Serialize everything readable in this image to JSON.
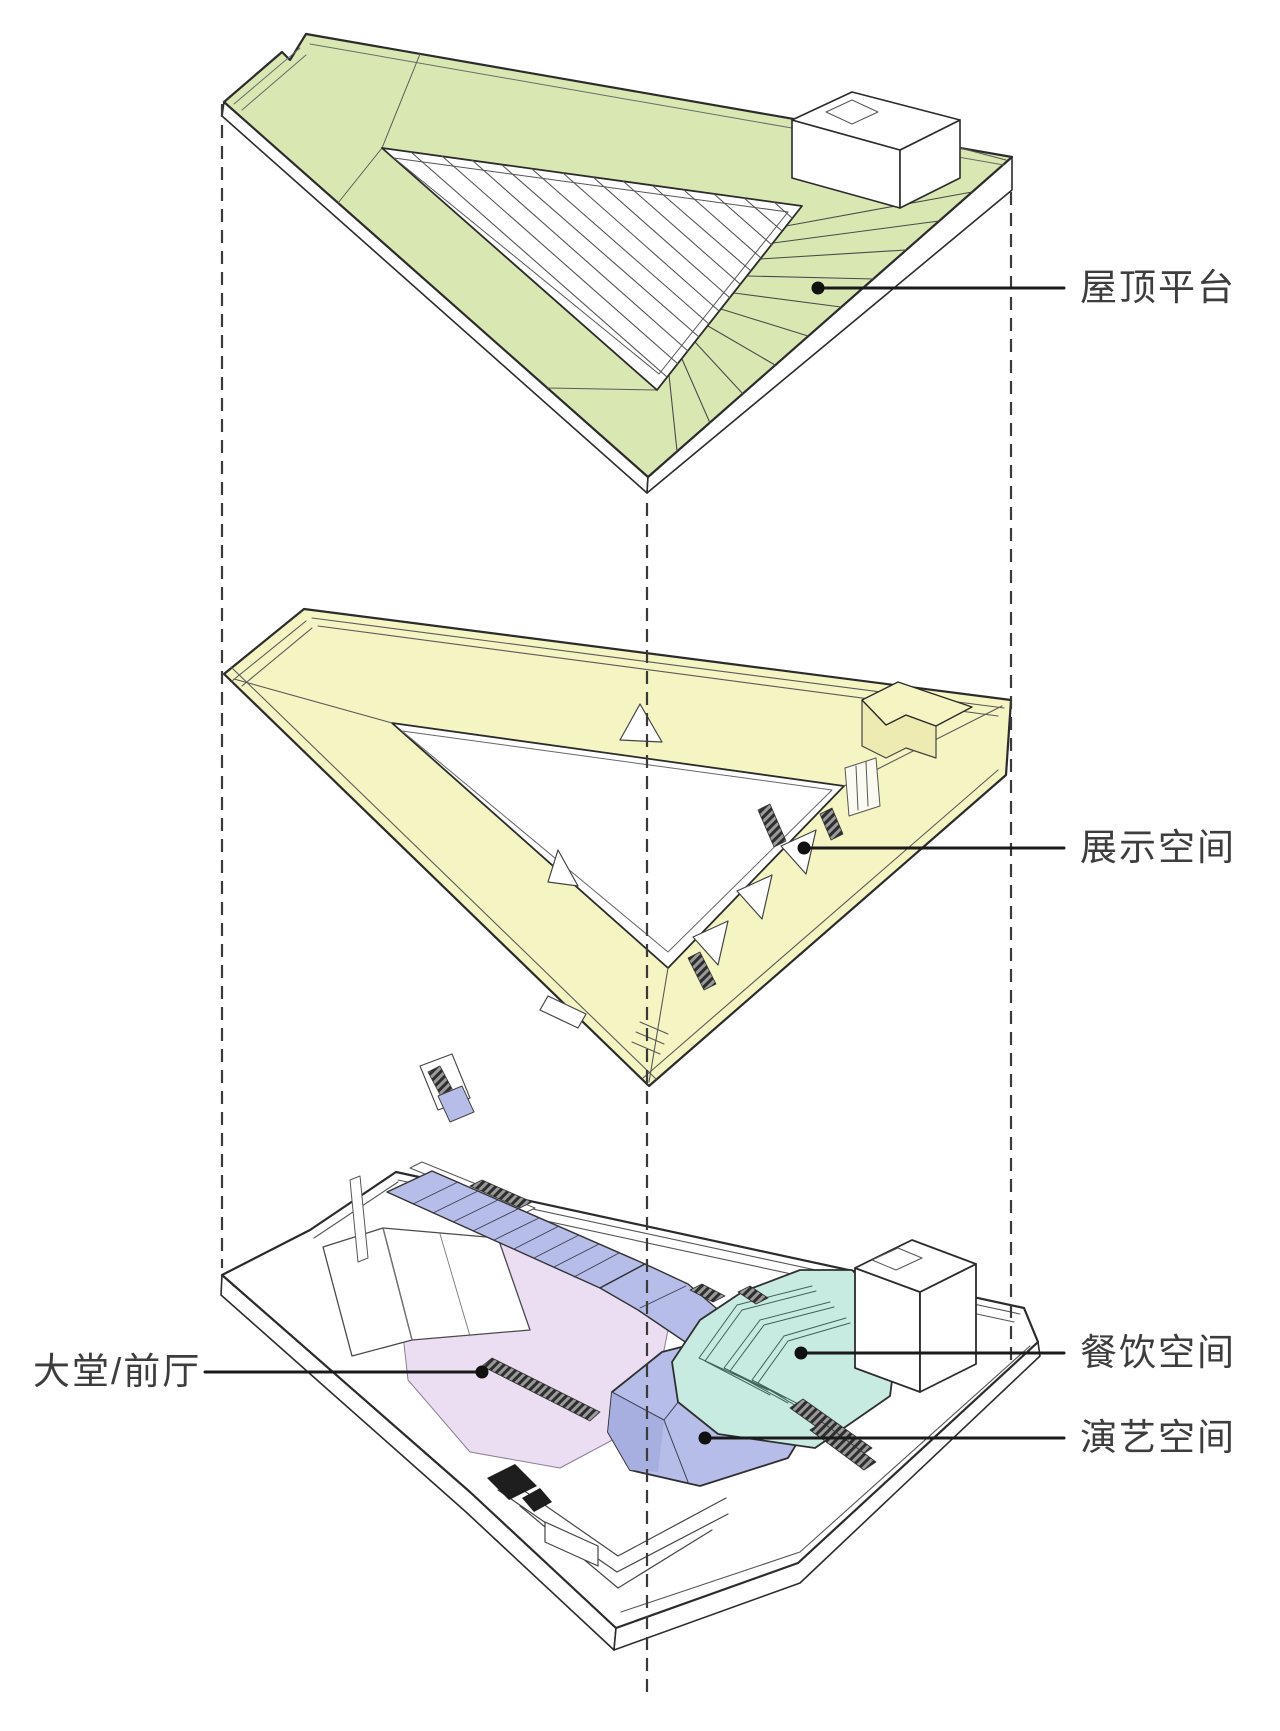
{
  "diagram": {
    "type": "exploded-axonometric-building-diagram",
    "levels": [
      {
        "id": "roof-level",
        "zone": "屋顶平台"
      },
      {
        "id": "exhibition-level",
        "zone": "展示空间"
      },
      {
        "id": "ground-level",
        "zones": [
          "大堂/前厅",
          "餐饮空间",
          "演艺空间"
        ]
      }
    ],
    "callouts": {
      "roof": "屋顶平台",
      "exhibition": "展示空间",
      "dining": "餐饮空间",
      "performance": "演艺空间",
      "lobby": "大堂/前厅"
    },
    "colors": {
      "roof_green": "#d9e8b2",
      "exhibition_yellow": "#f5f4c3",
      "exhibition_yellow_side": "#edebb2",
      "dining_teal": "#c8ebe1",
      "performance_blue": "#b6bde8",
      "performance_blue_dark": "#a7afe0",
      "lobby_pink": "#ecdef2",
      "outline": "#2b2b2b",
      "leader": "#1a1a1a",
      "guide": "#3a3a3a"
    }
  }
}
